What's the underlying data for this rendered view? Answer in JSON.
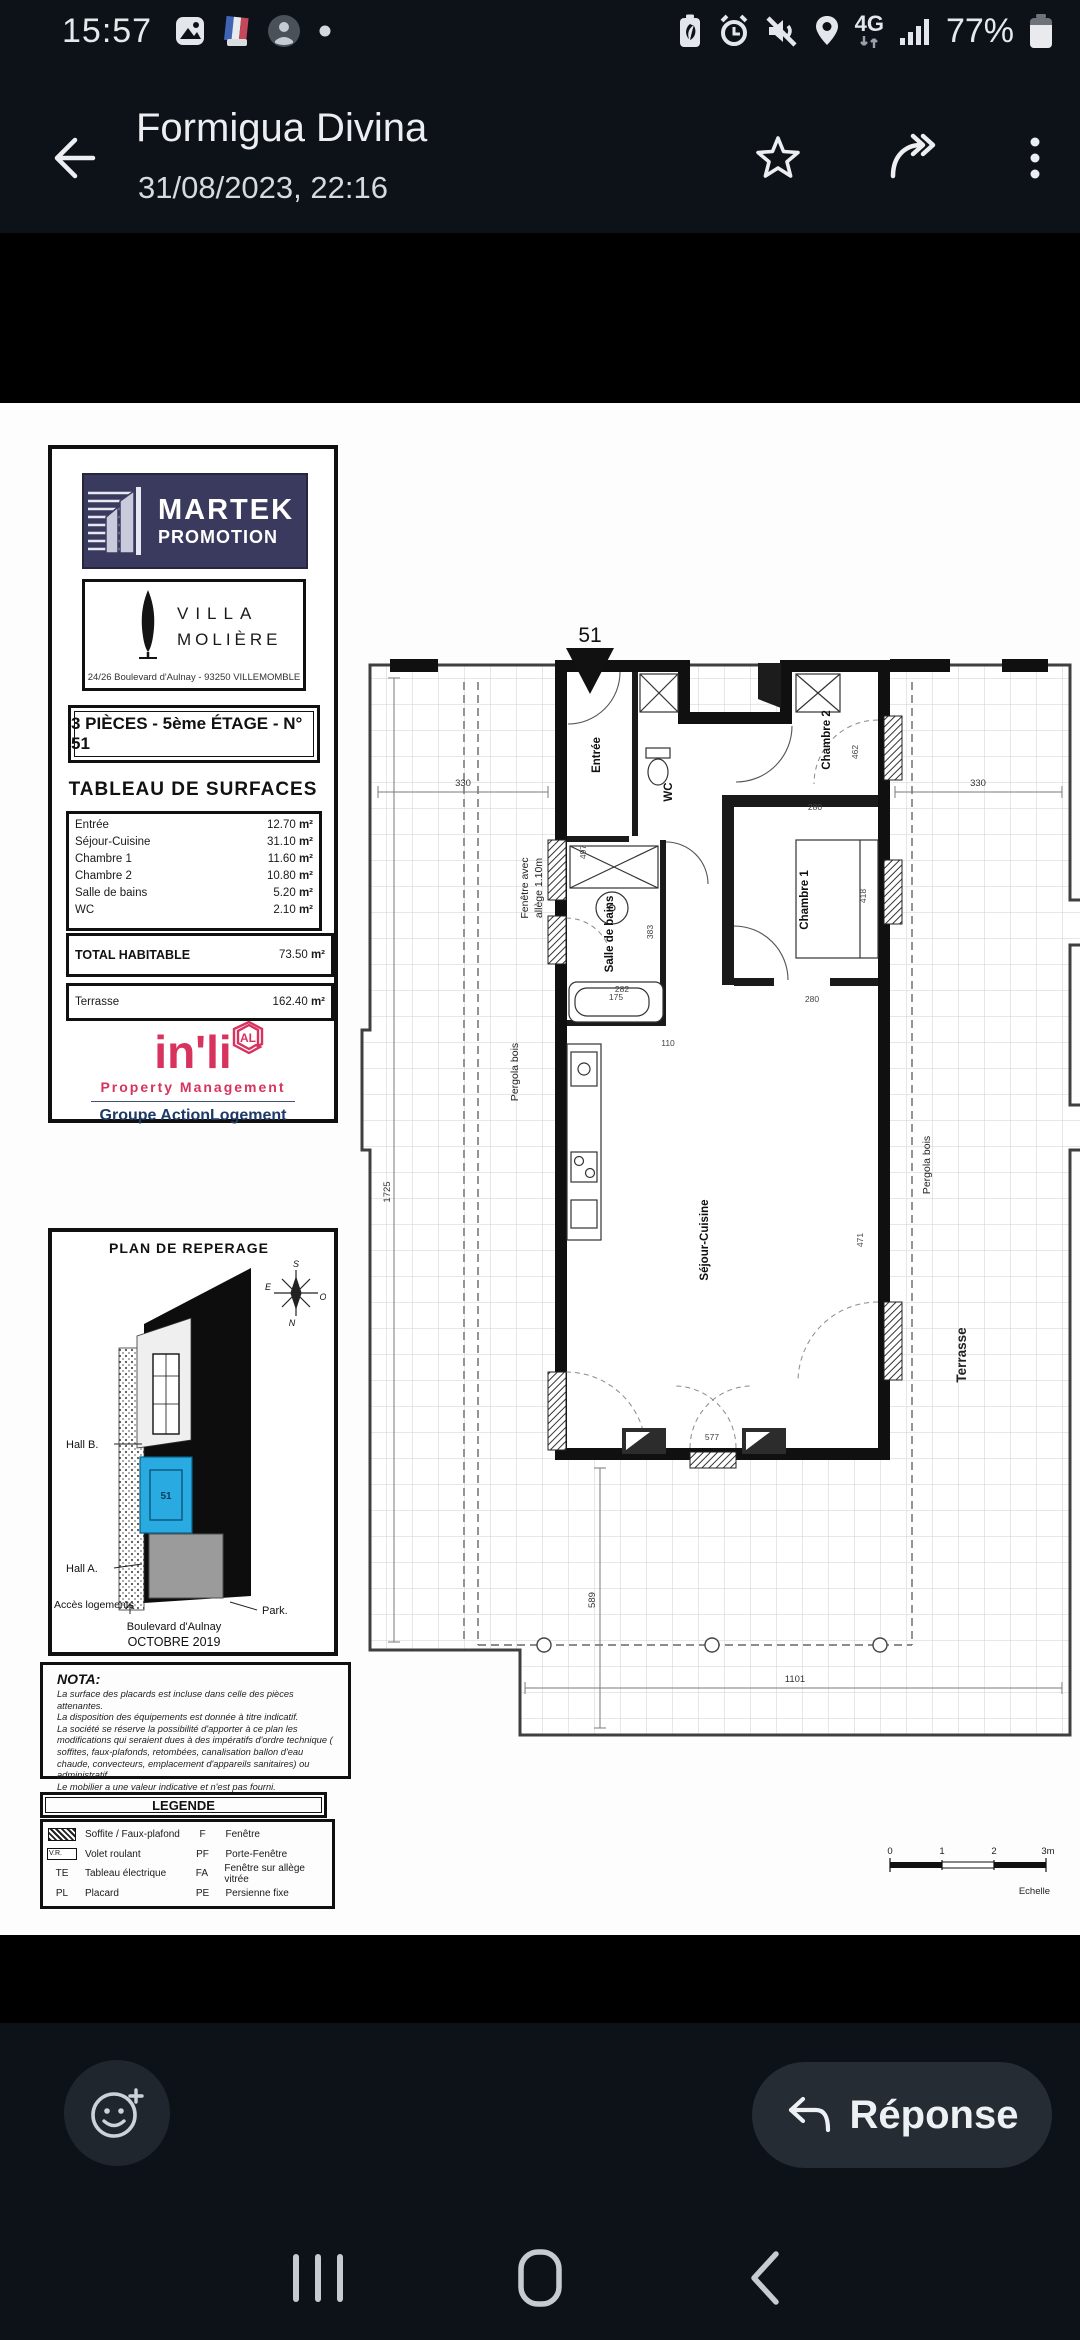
{
  "status_bar": {
    "time": "15:57",
    "network": "4G",
    "battery": "77%"
  },
  "header": {
    "title": "Formigua Divina",
    "subtitle": "31/08/2023, 22:16"
  },
  "doc": {
    "martek": {
      "line1": "MARTEK",
      "line2": "PROMOTION"
    },
    "villa": {
      "name1": "VILLA",
      "name2": "MOLIÈRE",
      "address": "24/26 Boulevard d'Aulnay - 93250 VILLEMOMBLE"
    },
    "banner": "3 PIÈCES - 5ème ÉTAGE - N° 51",
    "surfaces": {
      "title": "TABLEAU DE SURFACES",
      "rows": [
        {
          "label": "Entrée",
          "value": "12.70",
          "unit": "m²"
        },
        {
          "label": "Séjour-Cuisine",
          "value": "31.10",
          "unit": "m²"
        },
        {
          "label": "Chambre 1",
          "value": "11.60",
          "unit": "m²"
        },
        {
          "label": "Chambre 2",
          "value": "10.80",
          "unit": "m²"
        },
        {
          "label": "Salle de bains",
          "value": "5.20",
          "unit": "m²"
        },
        {
          "label": "WC",
          "value": "2.10",
          "unit": "m²"
        }
      ],
      "total_label": "TOTAL HABITABLE",
      "total_value": "73.50",
      "total_unit": "m²",
      "terrace_label": "Terrasse",
      "terrace_value": "162.40",
      "terrace_unit": "m²"
    },
    "inli": {
      "brand": "in'li",
      "badge": "AL",
      "tagline": "Property Management",
      "group": "Groupe ActionLogement"
    },
    "reperage": {
      "title": "PLAN DE REPERAGE",
      "unit": "51",
      "hall_b": "Hall B.",
      "hall_a": "Hall A.",
      "acces": "Accès logements",
      "park": "Park.",
      "street": "Boulevard d'Aulnay",
      "date": "OCTOBRE 2019",
      "compass": {
        "s": "S",
        "e": "E",
        "o": "O",
        "n": "N"
      }
    },
    "nota": {
      "title": "NOTA:",
      "lines": [
        "La surface des placards est incluse dans celle des pièces attenantes.",
        "La disposition des équipements est donnée à titre indicatif.",
        "La société se réserve la possibilité d'apporter à ce plan les modifications qui seraient dues à des impératifs d'ordre technique ( soffites, faux-plafonds, retombées, canalisation ballon d'eau chaude, convecteurs, emplacement d'appareils sanitaires) ou administratif.",
        "Le mobilier a une valeur indicative et n'est pas fourni."
      ]
    },
    "legende": {
      "title": "LEGENDE",
      "left": [
        {
          "label": "Soffite / Faux-plafond"
        },
        {
          "sym_text": "V.R.",
          "label": "Volet roulant"
        },
        {
          "code": "TE",
          "label": "Tableau électrique"
        },
        {
          "code": "PL",
          "label": "Placard"
        }
      ],
      "right": [
        {
          "code": "F",
          "label": "Fenêtre"
        },
        {
          "code": "PF",
          "label": "Porte-Fenêtre"
        },
        {
          "code": "FA",
          "label": "Fenêtre sur allège vitrée"
        },
        {
          "code": "PE",
          "label": "Persienne fixe"
        }
      ]
    },
    "plan": {
      "marker": "51",
      "rooms": {
        "entree": "Entrée",
        "wc": "WC",
        "ch2": "Chambre 2",
        "sdb": "Salle de bains",
        "ch1": "Chambre 1",
        "sejour": "Séjour-Cuisine"
      },
      "labels": {
        "fenetre1": "Fenêtre avec",
        "fenetre2": "allège 1.10m",
        "pergola_l": "Pergola bois",
        "pergola_r": "Pergola bois",
        "terrasse": "Terrasse"
      },
      "dims": {
        "d330l": "330",
        "d330r": "330",
        "d1725": "1725",
        "d1101": "1101",
        "d589": "589",
        "d497": "497",
        "d282": "282",
        "d280a": "280",
        "d462": "462",
        "d418": "418",
        "d280b": "280",
        "d471": "471",
        "d383": "383",
        "d175": "175",
        "d110": "110",
        "d577": "577"
      },
      "scale": {
        "s0": "0",
        "s1": "1",
        "s2": "2",
        "s3": "3m",
        "label": "Echelle"
      }
    }
  },
  "footer": {
    "reply": "Réponse"
  }
}
